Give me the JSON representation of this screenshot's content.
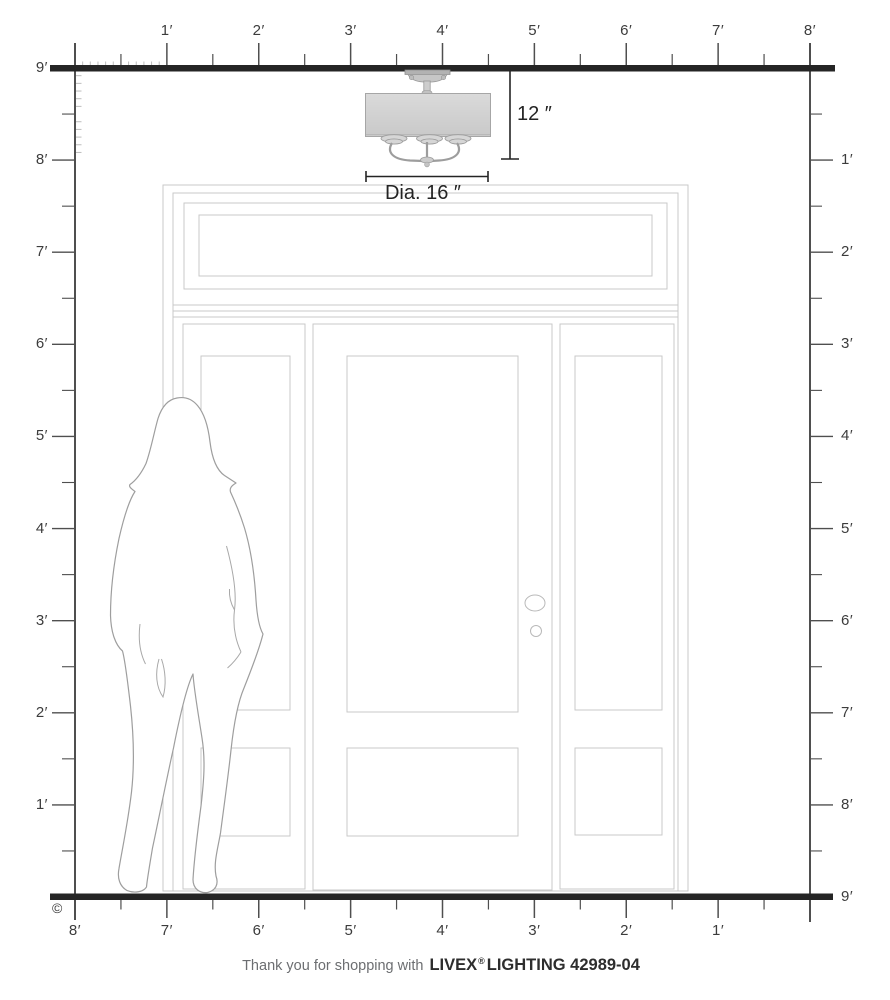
{
  "diagram": {
    "kind": "product size diagram",
    "product": "semi-flush ceiling light over entry door with human figure for scale"
  },
  "rulers": {
    "unit": "feet",
    "top_labels": [
      "1′",
      "2′",
      "3′",
      "4′",
      "5′",
      "6′",
      "7′",
      "8′"
    ],
    "left_labels": [
      "9′",
      "8′",
      "7′",
      "6′",
      "5′",
      "4′",
      "3′",
      "2′",
      "1′"
    ],
    "right_labels": [
      "1′",
      "2′",
      "3′",
      "4′",
      "5′",
      "6′",
      "7′",
      "8′",
      "9′"
    ],
    "bottom_labels": [
      "8′",
      "7′",
      "6′",
      "5′",
      "4′",
      "3′",
      "2′",
      "1′"
    ]
  },
  "fixture": {
    "height_label": "12 ″",
    "diameter_label": "Dia. 16 ″",
    "shade_color": "#d3d3d3",
    "metal_color": "#c6c6c6"
  },
  "footer": {
    "prefix": "Thank you for shopping with",
    "brand": "LIVEX",
    "registered": "®",
    "suffix": "LIGHTING 42989-04"
  },
  "copyright": "©",
  "colors": {
    "structure_line": "#252525",
    "ruler_line": "#4f4f4f",
    "minor_tick": "#bdbdbd",
    "label_text": "#3c3c3c",
    "door_line": "#c9c9c9",
    "silhouette_line": "#9e9e9e",
    "dimension_line": "#242424",
    "footer_gray": "#6c6e71",
    "footer_dark": "#2d2d2d"
  }
}
